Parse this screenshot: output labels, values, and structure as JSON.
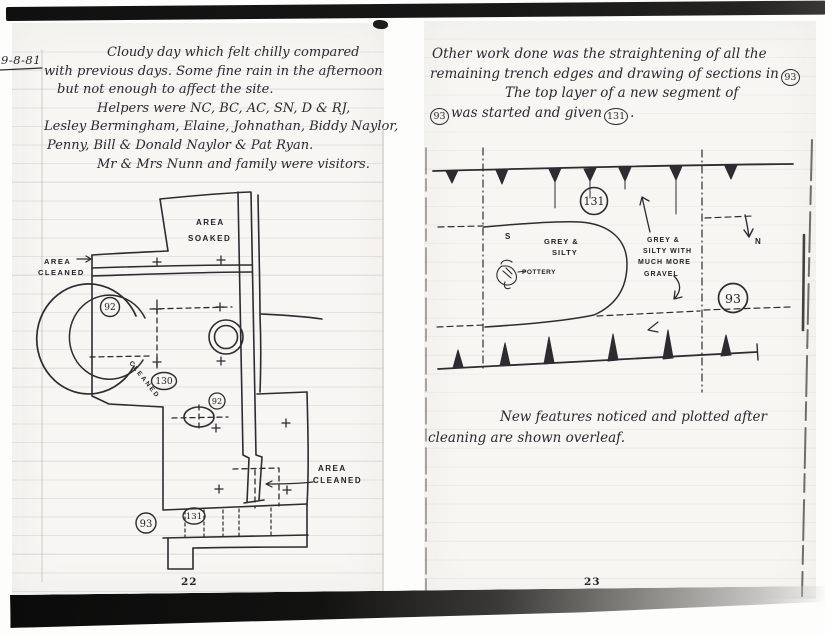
{
  "ink_color": "#2e2b31",
  "paper_color": "#f7f6f2",
  "date_label": "9-8-81",
  "left_page": {
    "page_number": "22",
    "journal_lines": [
      "Cloudy day which felt chilly compared",
      "with previous days. Some fine rain in the afternoon",
      "but not enough to affect the site.",
      "Helpers were NC, BC, AC, SN, D & RJ,",
      "Lesley Bermingham, Elaine, Johnathan, Biddy Naylor,",
      "Penny, Bill & Donald Naylor & Pat Ryan.",
      "Mr & Mrs Nunn and family were visitors."
    ],
    "plan": {
      "area_soaked_line1": "AREA",
      "area_soaked_line2": "SOAKED",
      "area_cleaned_left_line1": "AREA",
      "area_cleaned_left_line2": "CLEANED",
      "area_cleaned_right_line1": "AREA",
      "area_cleaned_right_line2": "CLEANED",
      "arc_text": "CLEANED",
      "ring_number": "92",
      "arc_number": "130",
      "ellipse_number": "92",
      "band_number": "131",
      "corner_number": "93"
    }
  },
  "right_page": {
    "page_number": "23",
    "para1": {
      "line1": "Other work done was the straightening of all the",
      "line2": "remaining trench edges and drawing of sections in",
      "line2_ref": "93",
      "line3": "The top layer of a new segment of",
      "line4_ref1": "93",
      "line4_mid": "was started and given",
      "line4_ref2": "131",
      "line4_end": "."
    },
    "para2": {
      "line1": "New features noticed and plotted after",
      "line2": "cleaning are shown overleaf."
    },
    "plan": {
      "segment_number": "131",
      "context_number": "93",
      "north_label": "N",
      "s_mark": "S",
      "grey_silty_line1": "GREY &",
      "grey_silty_line2": "SILTY",
      "gravel_line1": "GREY &",
      "gravel_line2": "SILTY WITH",
      "gravel_line3": "MUCH MORE",
      "gravel_line4": "GRAVEL",
      "pottery_label": "POTTERY"
    }
  }
}
